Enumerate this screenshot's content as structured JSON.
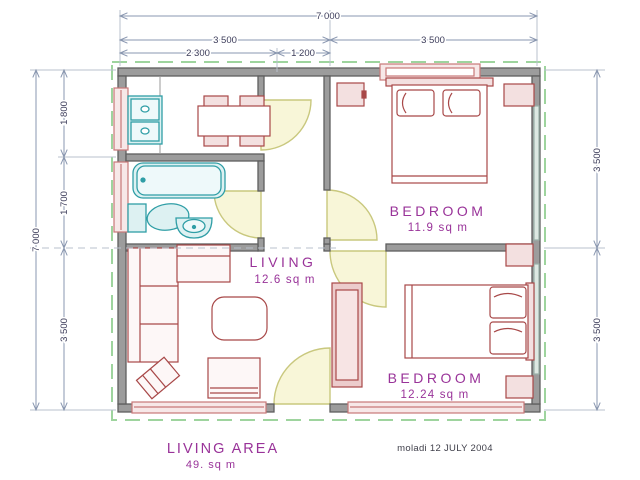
{
  "dimensions": {
    "top_total": "7 000",
    "top_left_half": "3 500",
    "top_right_half": "3 500",
    "top_kitchen": "2 300",
    "top_hall": "1 200",
    "left_total": "7 000",
    "left_top": "1 800",
    "left_mid": "1 700",
    "left_bottom": "3 500",
    "right_top": "3 500",
    "right_bottom": "3 500"
  },
  "rooms": {
    "bedroom1": {
      "name": "BEDROOM",
      "area": "11.9 sq m"
    },
    "bedroom2": {
      "name": "BEDROOM",
      "area": "12.24 sq m"
    },
    "living": {
      "name": "LIVING",
      "area": "12.6 sq m"
    }
  },
  "footer": {
    "area_label": "LIVING AREA",
    "area_value": "49. sq m",
    "credit": "moladi 12 JULY 2004"
  },
  "colors": {
    "dimension_line": "#8a97b0",
    "dimension_text": "#3c3c5a",
    "room_label": "#993399",
    "wall_fill": "#9c9c9c",
    "wall_stroke": "#5f5f5f",
    "furniture_red": "#a84848",
    "fixture_teal": "#2f9ea6",
    "door_arc": "#c9c87e",
    "door_fill": "#f8f6d8",
    "boundary_green": "#9ed49e"
  }
}
